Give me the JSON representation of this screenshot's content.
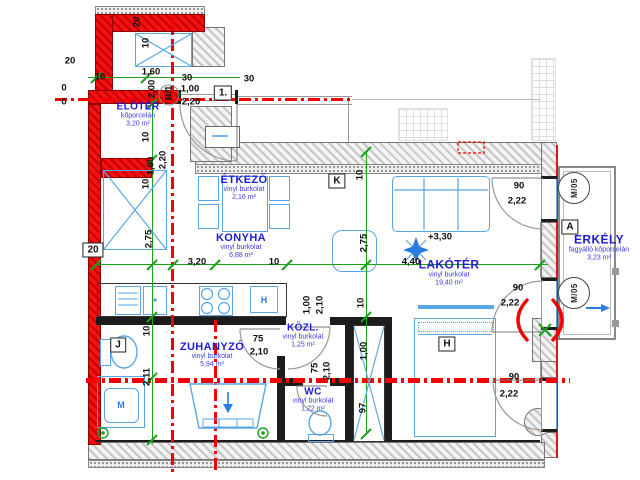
{
  "rooms": [
    {
      "name": "ELŐTÉR",
      "material": "kőporcelán",
      "area": "3,20 m²",
      "x": 138,
      "y": 115,
      "fs": 10
    },
    {
      "name": "ÉTKEZŐ",
      "material": "vinyl burkolat",
      "area": "2,16 m²",
      "x": 244,
      "y": 188,
      "fs": 11
    },
    {
      "name": "KONYHA",
      "material": "vinyl burkolat",
      "area": "6,88 m²",
      "x": 241,
      "y": 246,
      "fs": 11
    },
    {
      "name": "LAKÓTÉR",
      "material": "vinyl burkolat",
      "area": "19,40 m²",
      "x": 449,
      "y": 273,
      "fs": 12
    },
    {
      "name": "ERKÉLY",
      "material": "fagyálló kőporcelán",
      "area": "3,23 m²",
      "x": 599,
      "y": 248,
      "fs": 12
    },
    {
      "name": "ZUHANYZÓ",
      "material": "vinyl burkolat",
      "area": "5,94 m²",
      "x": 212,
      "y": 355,
      "fs": 11
    },
    {
      "name": "KÖZL.",
      "material": "vinyl burkolat",
      "area": "1,25 m²",
      "x": 303,
      "y": 336,
      "fs": 10
    },
    {
      "name": "WC",
      "material": "vinyl burkolat",
      "area": "1,22 m²",
      "x": 313,
      "y": 400,
      "fs": 10
    }
  ],
  "dimensions": [
    {
      "t": "20",
      "x": 137,
      "y": 22,
      "r": -90
    },
    {
      "t": "10",
      "x": 146,
      "y": 43,
      "r": -90
    },
    {
      "t": "20",
      "x": 70,
      "y": 61
    },
    {
      "t": "10",
      "x": 100,
      "y": 77
    },
    {
      "t": "1,60",
      "x": 151,
      "y": 72
    },
    {
      "t": "30",
      "x": 187,
      "y": 78
    },
    {
      "t": "1,00",
      "x": 190,
      "y": 89
    },
    {
      "t": "2,00",
      "x": 152,
      "y": 89,
      "r": -90
    },
    {
      "t": "2,20",
      "x": 191,
      "y": 102
    },
    {
      "t": "B/1",
      "x": 169,
      "y": 93,
      "r": -90
    },
    {
      "t": "30",
      "x": 249,
      "y": 79
    },
    {
      "t": "0",
      "x": 64,
      "y": 88
    },
    {
      "t": "0",
      "x": 64,
      "y": 102
    },
    {
      "t": "10",
      "x": 146,
      "y": 137,
      "r": -90
    },
    {
      "t": "1,00",
      "x": 151,
      "y": 166,
      "r": -90
    },
    {
      "t": "2,20",
      "x": 163,
      "y": 160,
      "r": -90
    },
    {
      "t": "10",
      "x": 146,
      "y": 184,
      "r": -90
    },
    {
      "t": "2,75",
      "x": 149,
      "y": 239,
      "r": -90
    },
    {
      "t": "3,20",
      "x": 197,
      "y": 262
    },
    {
      "t": "10",
      "x": 274,
      "y": 262
    },
    {
      "t": "10",
      "x": 360,
      "y": 175,
      "r": -90
    },
    {
      "t": "2,75",
      "x": 364,
      "y": 243,
      "r": -90
    },
    {
      "t": "4,40",
      "x": 411,
      "y": 262
    },
    {
      "t": "+3,30",
      "x": 440,
      "y": 237
    },
    {
      "t": "90",
      "x": 519,
      "y": 186
    },
    {
      "t": "2,22",
      "x": 517,
      "y": 201
    },
    {
      "t": "90",
      "x": 518,
      "y": 288
    },
    {
      "t": "2,22",
      "x": 510,
      "y": 303
    },
    {
      "t": "90",
      "x": 514,
      "y": 377
    },
    {
      "t": "2,22",
      "x": 509,
      "y": 394
    },
    {
      "t": "10",
      "x": 147,
      "y": 331,
      "r": -90
    },
    {
      "t": "2,11",
      "x": 147,
      "y": 377,
      "r": -90
    },
    {
      "t": "75",
      "x": 258,
      "y": 339
    },
    {
      "t": "2,10",
      "x": 259,
      "y": 352
    },
    {
      "t": "1,00",
      "x": 307,
      "y": 305,
      "r": -90
    },
    {
      "t": "2,10",
      "x": 320,
      "y": 305,
      "r": -90
    },
    {
      "t": "10",
      "x": 361,
      "y": 303,
      "r": -90
    },
    {
      "t": "75",
      "x": 315,
      "y": 368,
      "r": -90
    },
    {
      "t": "2,10",
      "x": 327,
      "y": 371,
      "r": -90
    },
    {
      "t": "1,00",
      "x": 364,
      "y": 351,
      "r": -90
    },
    {
      "t": "97",
      "x": 363,
      "y": 408,
      "r": -90
    }
  ],
  "markers": [
    {
      "t": "1.",
      "x": 223,
      "y": 93,
      "shape": "box"
    },
    {
      "t": "20",
      "x": 93,
      "y": 250,
      "shape": "box"
    },
    {
      "t": "K",
      "x": 337,
      "y": 181,
      "shape": "box"
    },
    {
      "t": "A",
      "x": 570,
      "y": 227,
      "shape": "box"
    },
    {
      "t": "J",
      "x": 118,
      "y": 345,
      "shape": "box"
    },
    {
      "t": "H",
      "x": 447,
      "y": 344,
      "shape": "box"
    },
    {
      "t": "M/05",
      "x": 574,
      "y": 188,
      "shape": "circle"
    },
    {
      "t": "M/05",
      "x": 574,
      "y": 293,
      "shape": "circle"
    },
    {
      "t": "H",
      "x": 264,
      "y": 300,
      "shape": "blue"
    },
    {
      "t": "M",
      "x": 121,
      "y": 405,
      "shape": "blue"
    }
  ],
  "colors": {
    "new_wall_red": "#f51111",
    "axis_red": "#f40000",
    "furniture_blue": "#58a6e8",
    "dimension_green": "#1aa11a",
    "room_label_blue": "#1c1cd6"
  }
}
